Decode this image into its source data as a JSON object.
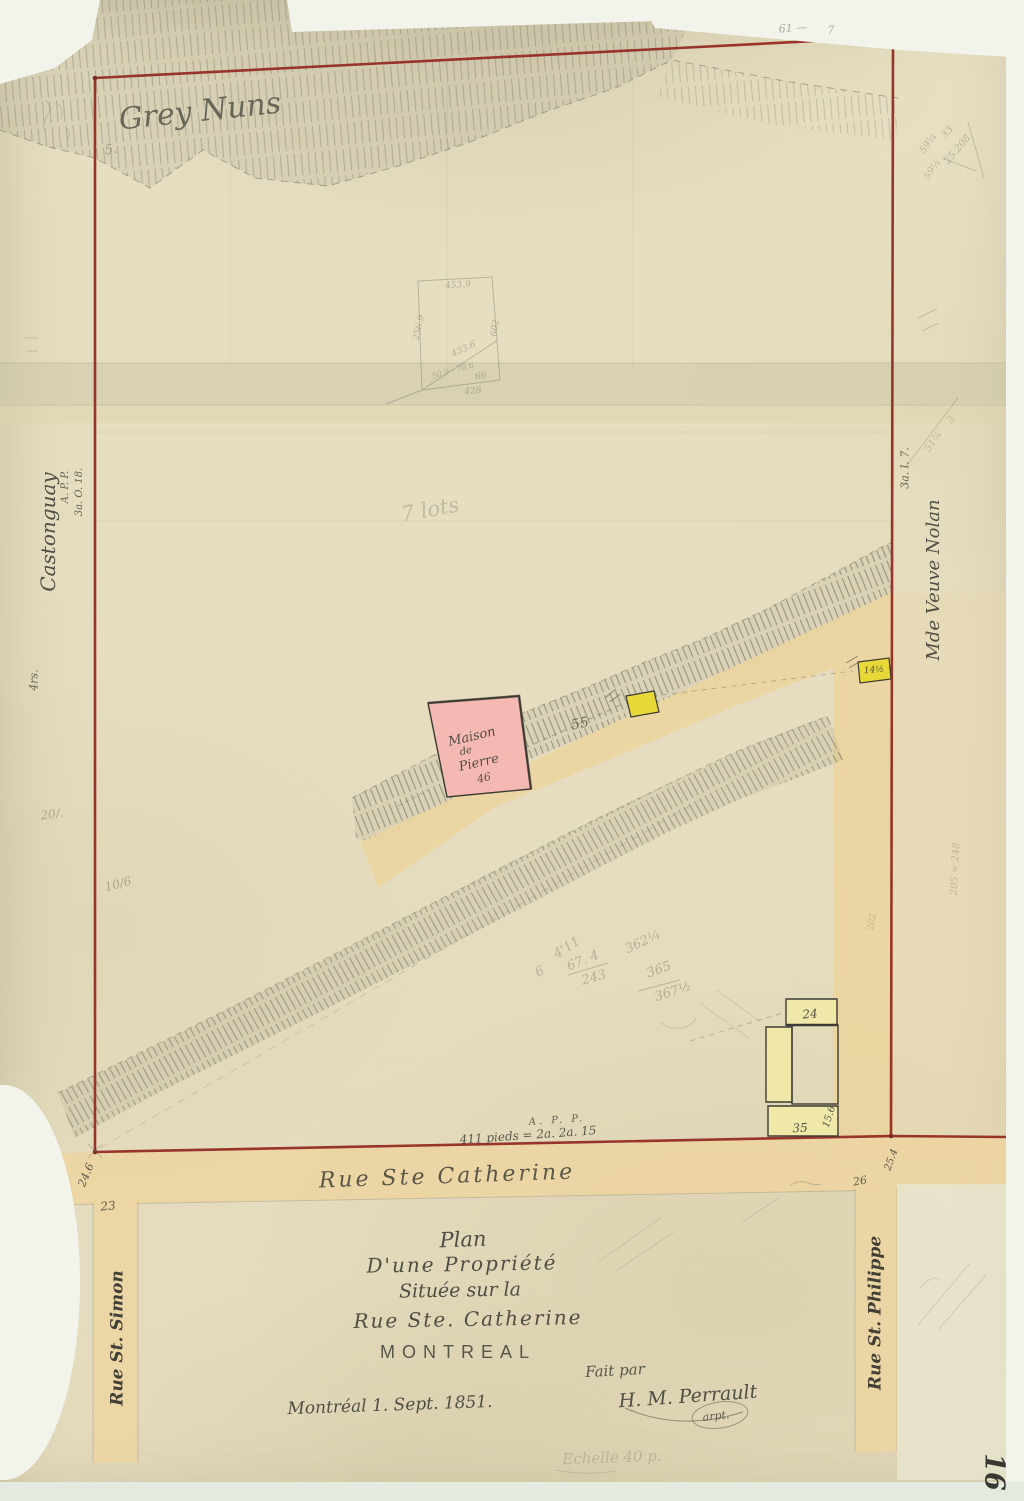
{
  "palette": {
    "paper": "#e6dec0",
    "boundary_red": "#97352b",
    "road_tan": "#ebd5a0",
    "pink_building": "#f4b9b2",
    "bright_yellow_building": "#e8d838",
    "pale_yellow_building": "#f0e8a8",
    "ink": "#3f4038",
    "pencil": "#72725f"
  },
  "title_block": {
    "line1": "Plan",
    "line2": "D'une Propriété",
    "line3": "Située sur la",
    "line4": "Rue Ste. Catherine",
    "city": "MONTREAL",
    "made_by": "Fait par",
    "signature": "H. M. Perrault",
    "signature_title": "arpt.",
    "date": "Montréal 1. Sept. 1851.",
    "scale_note": "Echelle 40 p."
  },
  "streets": {
    "bottom": "Rue Ste Catherine",
    "left": "Rue St. Simon",
    "right": "Rue St. Philippe"
  },
  "owners": {
    "top": "Grey Nuns",
    "left": "Castonguay",
    "right": "Mde Veuve Nolan"
  },
  "buildings": {
    "stone_house": [
      "Maison",
      "de",
      "Pierre",
      "46"
    ],
    "yellow_small": "14½",
    "lot_24": "24",
    "lot_35": "35",
    "lot_35_depth": "15.6"
  },
  "labels": [
    {
      "id": "grey-nuns",
      "text": "Grey Nuns",
      "x": 200,
      "y": 112,
      "size": 30,
      "rot": -6,
      "cls": "hw pencil-dark",
      "op": 0.85
    },
    {
      "id": "grey-nuns-note",
      "text": "5.",
      "x": 111,
      "y": 150,
      "size": 13,
      "rot": -10,
      "cls": "hw pencil",
      "op": 0.55
    },
    {
      "id": "owner-castonguay",
      "text": "Castonguay",
      "x": 48,
      "y": 532,
      "size": 20,
      "rot": -90,
      "cls": "hw ink",
      "op": 0.9
    },
    {
      "id": "left-app",
      "text": "A. P. P.",
      "x": 66,
      "y": 487,
      "size": 10,
      "rot": -90,
      "cls": "hw ink",
      "op": 0.8
    },
    {
      "id": "left-measure",
      "text": "3a. O. 18.",
      "x": 80,
      "y": 492,
      "size": 10,
      "rot": -90,
      "cls": "hw ink",
      "op": 0.8
    },
    {
      "id": "left-prs",
      "text": "4rs.",
      "x": 34,
      "y": 680,
      "size": 11,
      "rot": -90,
      "cls": "hw ink",
      "op": 0.75
    },
    {
      "id": "owner-nolan",
      "text": "Mde Veuve Nolan",
      "x": 934,
      "y": 580,
      "size": 18,
      "rot": -90,
      "cls": "hw ink",
      "op": 0.9
    },
    {
      "id": "right-measure",
      "text": "3a. l. 7.",
      "x": 905,
      "y": 468,
      "size": 11,
      "rot": -90,
      "cls": "hw ink",
      "op": 0.8
    },
    {
      "id": "seven-lots",
      "text": "7 lots",
      "x": 430,
      "y": 510,
      "size": 21,
      "rot": -10,
      "cls": "hw pencil",
      "op": 0.32
    },
    {
      "id": "measure-55",
      "text": "55",
      "x": 580,
      "y": 724,
      "size": 14,
      "rot": -12,
      "cls": "hw pencil-dark",
      "op": 0.8
    },
    {
      "id": "maison-line1",
      "text": "Maison",
      "x": 472,
      "y": 737,
      "size": 13,
      "rot": -13,
      "cls": "hw ink",
      "op": 0.9
    },
    {
      "id": "maison-line2",
      "text": "de",
      "x": 466,
      "y": 752,
      "size": 10,
      "rot": -13,
      "cls": "hw ink",
      "op": 0.9
    },
    {
      "id": "maison-line3",
      "text": "Pierre",
      "x": 479,
      "y": 763,
      "size": 13,
      "rot": -13,
      "cls": "hw ink",
      "op": 0.9
    },
    {
      "id": "maison-number",
      "text": "46",
      "x": 484,
      "y": 778,
      "size": 11,
      "rot": -13,
      "cls": "hw ink",
      "op": 0.85
    },
    {
      "id": "yellow-sq-label",
      "text": "14½",
      "x": 874,
      "y": 671,
      "size": 9,
      "rot": -4,
      "cls": "hw ink",
      "op": 0.9
    },
    {
      "id": "lot-24-label",
      "text": "24",
      "x": 810,
      "y": 1014,
      "size": 12,
      "rot": -5,
      "cls": "hw ink",
      "op": 0.9
    },
    {
      "id": "lot-35-label",
      "text": "35",
      "x": 800,
      "y": 1128,
      "size": 12,
      "rot": -3,
      "cls": "hw ink",
      "op": 0.9
    },
    {
      "id": "lot-35-depth",
      "text": "15.6",
      "x": 830,
      "y": 1117,
      "size": 10,
      "rot": -72,
      "cls": "hw ink",
      "op": 0.85
    },
    {
      "id": "bottom-app",
      "text": "A. P. P.",
      "x": 557,
      "y": 1121,
      "size": 10,
      "rot": -4,
      "cls": "hw ink",
      "op": 0.8,
      "ls": 3
    },
    {
      "id": "bottom-pieds",
      "text": "411 pieds = 2a. 2a. 15",
      "x": 528,
      "y": 1135,
      "size": 12,
      "rot": -4,
      "cls": "hw ink",
      "op": 0.85
    },
    {
      "id": "street-catherine",
      "text": "Rue Ste Catherine",
      "x": 447,
      "y": 1177,
      "size": 22,
      "rot": -2,
      "cls": "hw ink",
      "op": 0.85,
      "ls": 3
    },
    {
      "id": "measure-246",
      "text": "24.6",
      "x": 86,
      "y": 1175,
      "size": 11,
      "rot": -68,
      "cls": "hw ink",
      "op": 0.85
    },
    {
      "id": "lot-23",
      "text": "23",
      "x": 108,
      "y": 1206,
      "size": 12,
      "rot": -5,
      "cls": "hw ink",
      "op": 0.8
    },
    {
      "id": "measure-254",
      "text": "25.4",
      "x": 892,
      "y": 1160,
      "size": 10,
      "rot": -70,
      "cls": "hw ink",
      "op": 0.85
    },
    {
      "id": "lot-26",
      "text": "26",
      "x": 860,
      "y": 1181,
      "size": 11,
      "rot": -10,
      "cls": "hw ink",
      "op": 0.8
    },
    {
      "id": "title-plan",
      "text": "Plan",
      "x": 463,
      "y": 1240,
      "size": 21,
      "rot": -2,
      "cls": "hw ink",
      "op": 0.9
    },
    {
      "id": "title-line2",
      "text": "D'une Propriété",
      "x": 462,
      "y": 1264,
      "size": 20,
      "rot": -1,
      "cls": "hw ink",
      "op": 0.9,
      "ls": 2
    },
    {
      "id": "title-line3",
      "text": "Située sur la",
      "x": 460,
      "y": 1291,
      "size": 19,
      "rot": -1,
      "cls": "hw ink",
      "op": 0.9
    },
    {
      "id": "title-line4",
      "text": "Rue Ste. Catherine",
      "x": 468,
      "y": 1319,
      "size": 20,
      "rot": -1,
      "cls": "hw ink",
      "op": 0.9,
      "ls": 2
    },
    {
      "id": "title-montreal",
      "text": "MONTREAL",
      "x": 458,
      "y": 1352,
      "size": 18,
      "rot": 0,
      "cls": "print ink",
      "op": 0.85,
      "ls": 7
    },
    {
      "id": "fait-par",
      "text": "Fait par",
      "x": 615,
      "y": 1371,
      "size": 15,
      "rot": -3,
      "cls": "hw ink",
      "op": 0.85
    },
    {
      "id": "signature",
      "text": "H. M. Perrault",
      "x": 688,
      "y": 1397,
      "size": 19,
      "rot": -4,
      "cls": "hw ink",
      "op": 0.9
    },
    {
      "id": "signature-title",
      "text": "arpt.",
      "x": 716,
      "y": 1416,
      "size": 11,
      "rot": -6,
      "cls": "hw ink",
      "op": 0.8
    },
    {
      "id": "date-line",
      "text": "Montréal 1. Sept. 1851.",
      "x": 390,
      "y": 1406,
      "size": 17,
      "rot": -2,
      "cls": "hw ink",
      "op": 0.9
    },
    {
      "id": "scale-note",
      "text": "Echelle 40 p.",
      "x": 612,
      "y": 1458,
      "size": 15,
      "rot": -2,
      "cls": "hw pencil",
      "op": 0.3
    },
    {
      "id": "street-simon",
      "text": "Rue St. Simon",
      "x": 118,
      "y": 1338,
      "size": 17,
      "rot": -90,
      "cls": "hw ink-dark bold",
      "op": 0.9
    },
    {
      "id": "street-philippe",
      "text": "Rue St. Philippe",
      "x": 876,
      "y": 1313,
      "size": 17,
      "rot": -90,
      "cls": "hw ink-dark bold",
      "op": 0.9
    },
    {
      "id": "folio-16",
      "text": "16",
      "x": 994,
      "y": 1472,
      "size": 27,
      "rot": 90,
      "cls": "hw ink-dark bold",
      "op": 0.95
    },
    {
      "id": "pencil-61",
      "text": "61 —",
      "x": 793,
      "y": 28,
      "size": 11,
      "rot": -4,
      "cls": "hw pencil",
      "op": 0.55
    },
    {
      "id": "pencil-7",
      "text": "7",
      "x": 831,
      "y": 30,
      "size": 11,
      "rot": 0,
      "cls": "hw pencil",
      "op": 0.55
    },
    {
      "id": "calc-6",
      "text": "6",
      "x": 540,
      "y": 972,
      "size": 13,
      "rot": -30,
      "cls": "hw pencil",
      "op": 0.4
    },
    {
      "id": "calc-411",
      "text": "4'11",
      "x": 567,
      "y": 948,
      "size": 13,
      "rot": -32,
      "cls": "hw pencil",
      "op": 0.4
    },
    {
      "id": "calc-674",
      "text": "67. 4",
      "x": 583,
      "y": 961,
      "size": 13,
      "rot": -22,
      "cls": "hw pencil",
      "op": 0.42
    },
    {
      "id": "calc-243",
      "text": "243",
      "x": 594,
      "y": 978,
      "size": 13,
      "rot": -16,
      "cls": "hw pencil",
      "op": 0.42
    },
    {
      "id": "calc-362",
      "text": "362¼",
      "x": 643,
      "y": 942,
      "size": 13,
      "rot": -26,
      "cls": "hw pencil",
      "op": 0.42
    },
    {
      "id": "calc-365",
      "text": "365",
      "x": 659,
      "y": 970,
      "size": 13,
      "rot": -20,
      "cls": "hw pencil",
      "op": 0.45
    },
    {
      "id": "calc-367",
      "text": "367½",
      "x": 673,
      "y": 992,
      "size": 13,
      "rot": -18,
      "cls": "hw pencil",
      "op": 0.45
    },
    {
      "id": "sketch-4539",
      "text": "453.9",
      "x": 458,
      "y": 286,
      "size": 9,
      "rot": -3,
      "cls": "hw pencil",
      "op": 0.45
    },
    {
      "id": "sketch-2569",
      "text": "256.9",
      "x": 420,
      "y": 328,
      "size": 9,
      "rot": -76,
      "cls": "hw pencil",
      "op": 0.45
    },
    {
      "id": "sketch-602",
      "text": "602",
      "x": 496,
      "y": 328,
      "size": 9,
      "rot": -80,
      "cls": "hw pencil",
      "op": 0.45
    },
    {
      "id": "sketch-4336",
      "text": "433.6",
      "x": 464,
      "y": 350,
      "size": 9,
      "rot": -26,
      "cls": "hw pencil",
      "op": 0.45
    },
    {
      "id": "sketch-509",
      "text": "50.9 · 70.6",
      "x": 453,
      "y": 371,
      "size": 8,
      "rot": -16,
      "cls": "hw pencil",
      "op": 0.4
    },
    {
      "id": "sketch-66",
      "text": "66",
      "x": 481,
      "y": 377,
      "size": 9,
      "rot": -8,
      "cls": "hw pencil",
      "op": 0.45
    },
    {
      "id": "sketch-428",
      "text": "428",
      "x": 473,
      "y": 392,
      "size": 9,
      "rot": -5,
      "cls": "hw pencil",
      "op": 0.45
    },
    {
      "id": "note-20",
      "text": "20/.",
      "x": 52,
      "y": 814,
      "size": 12,
      "rot": -8,
      "cls": "hw pencil",
      "op": 0.5
    },
    {
      "id": "note-106",
      "text": "10/6",
      "x": 118,
      "y": 884,
      "size": 12,
      "rot": -15,
      "cls": "hw pencil",
      "op": 0.5
    },
    {
      "id": "tr-33",
      "text": "33",
      "x": 948,
      "y": 133,
      "size": 10,
      "rot": -50,
      "cls": "hw pencil",
      "op": 0.4
    },
    {
      "id": "tr-59a",
      "text": "59¼",
      "x": 929,
      "y": 144,
      "size": 10,
      "rot": -55,
      "cls": "hw pencil",
      "op": 0.4
    },
    {
      "id": "tr-25208",
      "text": "25.208",
      "x": 958,
      "y": 150,
      "size": 10,
      "rot": -50,
      "cls": "hw pencil",
      "op": 0.4
    },
    {
      "id": "tr-59b",
      "text": "59¼",
      "x": 933,
      "y": 170,
      "size": 10,
      "rot": -55,
      "cls": "hw pencil",
      "op": 0.38
    },
    {
      "id": "tr-51",
      "text": "51¾",
      "x": 934,
      "y": 442,
      "size": 10,
      "rot": -55,
      "cls": "hw pencil",
      "op": 0.35
    },
    {
      "id": "tr-3",
      "text": "3",
      "x": 952,
      "y": 420,
      "size": 10,
      "rot": -55,
      "cls": "hw pencil",
      "op": 0.3
    },
    {
      "id": "rm-205",
      "text": "205 = 248",
      "x": 956,
      "y": 869,
      "size": 10,
      "rot": -87,
      "cls": "hw pencil",
      "op": 0.35
    },
    {
      "id": "rm-202",
      "text": "202",
      "x": 873,
      "y": 922,
      "size": 9,
      "rot": -80,
      "cls": "hw pencil",
      "op": 0.35
    }
  ]
}
